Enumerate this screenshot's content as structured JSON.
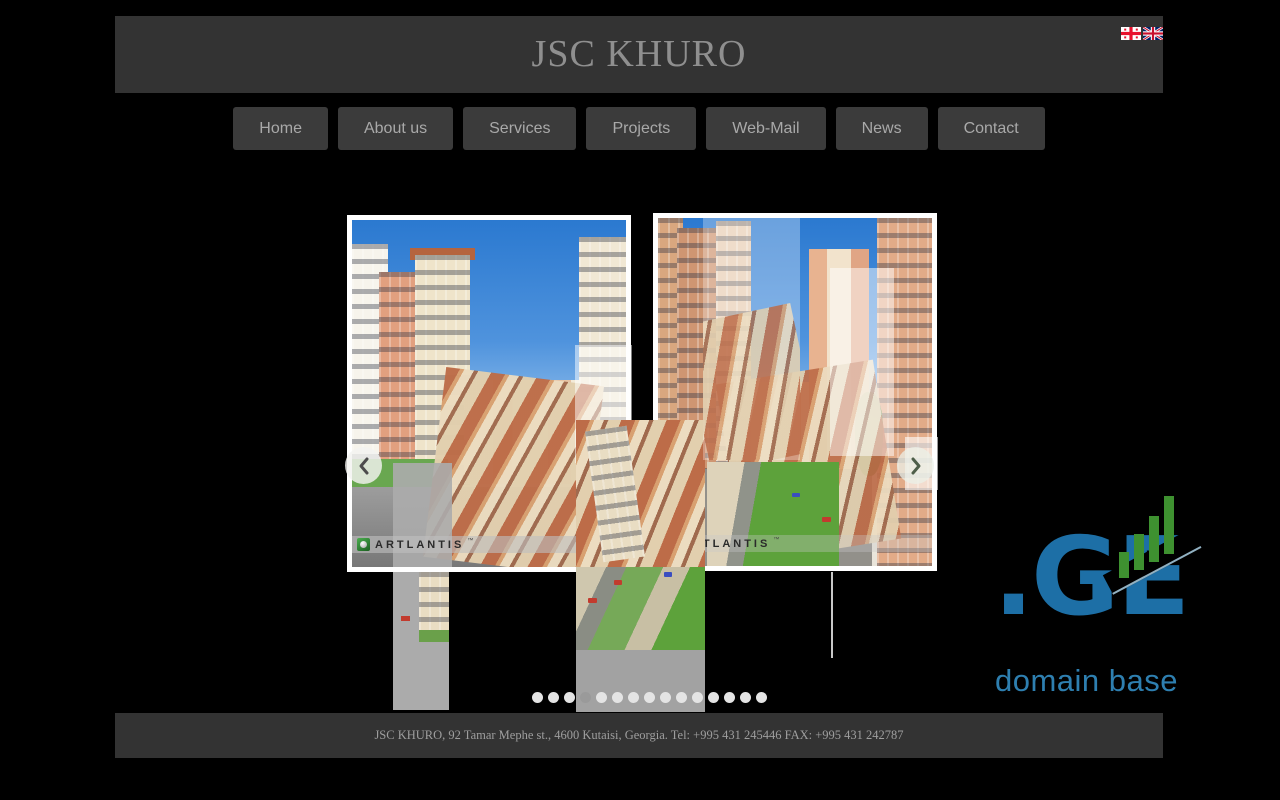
{
  "header": {
    "title": "JSC KHURO"
  },
  "language_switcher": {
    "flags": [
      {
        "name": "georgia"
      },
      {
        "name": "united-kingdom"
      }
    ]
  },
  "nav": {
    "items": [
      {
        "label": "Home"
      },
      {
        "label": "About us"
      },
      {
        "label": "Services"
      },
      {
        "label": "Projects"
      },
      {
        "label": "Web-Mail"
      },
      {
        "label": "News"
      },
      {
        "label": "Contact"
      }
    ]
  },
  "carousel": {
    "watermark": {
      "brand": "ARTLANTIS",
      "tm": "™"
    },
    "dots": {
      "count": 15,
      "active_index": 3
    }
  },
  "ge_logo": {
    "domain": ".GE",
    "tagline": "domain base",
    "blue": "#1d6fa6",
    "green": "#3e9130"
  },
  "footer": {
    "text": "JSC KHURO, 92 Tamar Mephe st., 4600 Kutaisi, Georgia. Tel: +995 431 245446 FAX: +995 431 242787"
  },
  "colors": {
    "background": "#000000",
    "panel": "#333333",
    "nav_button": "#3b3b3b",
    "nav_text": "#a9a9a9",
    "title_text": "#8f8f8f",
    "footer_text": "#9e9e9e"
  }
}
